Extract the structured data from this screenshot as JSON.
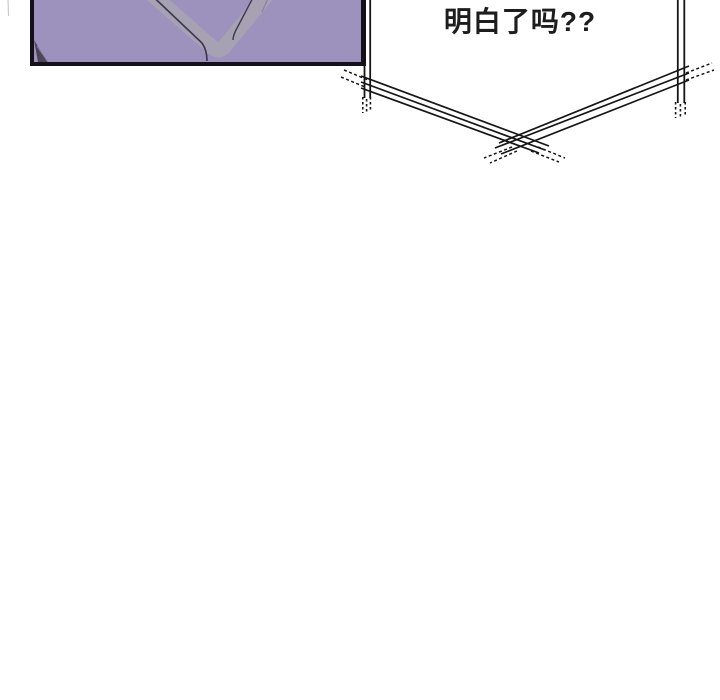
{
  "page": {
    "width": 720,
    "height": 700,
    "background": "#ffffff"
  },
  "panel": {
    "description": "purple close-up panel of a V-neck garment, cropped by top edge",
    "fill": "#9c92bd",
    "border_color": "#15111b",
    "collar_band_color": "#a7a1b4",
    "collar_line_color": "#3f3950",
    "corner_fold_color": "#4c4659",
    "corner_fold_highlight": "#8d85a0"
  },
  "speech_bubble": {
    "text": "明白了吗??",
    "style": "angular sketchy balloon, open at top, V-point at bottom",
    "line_color": "#161616",
    "fill": "#ffffff",
    "text_color": "#1d1d1d"
  },
  "artifact": {
    "color": "#c9c9c9"
  }
}
